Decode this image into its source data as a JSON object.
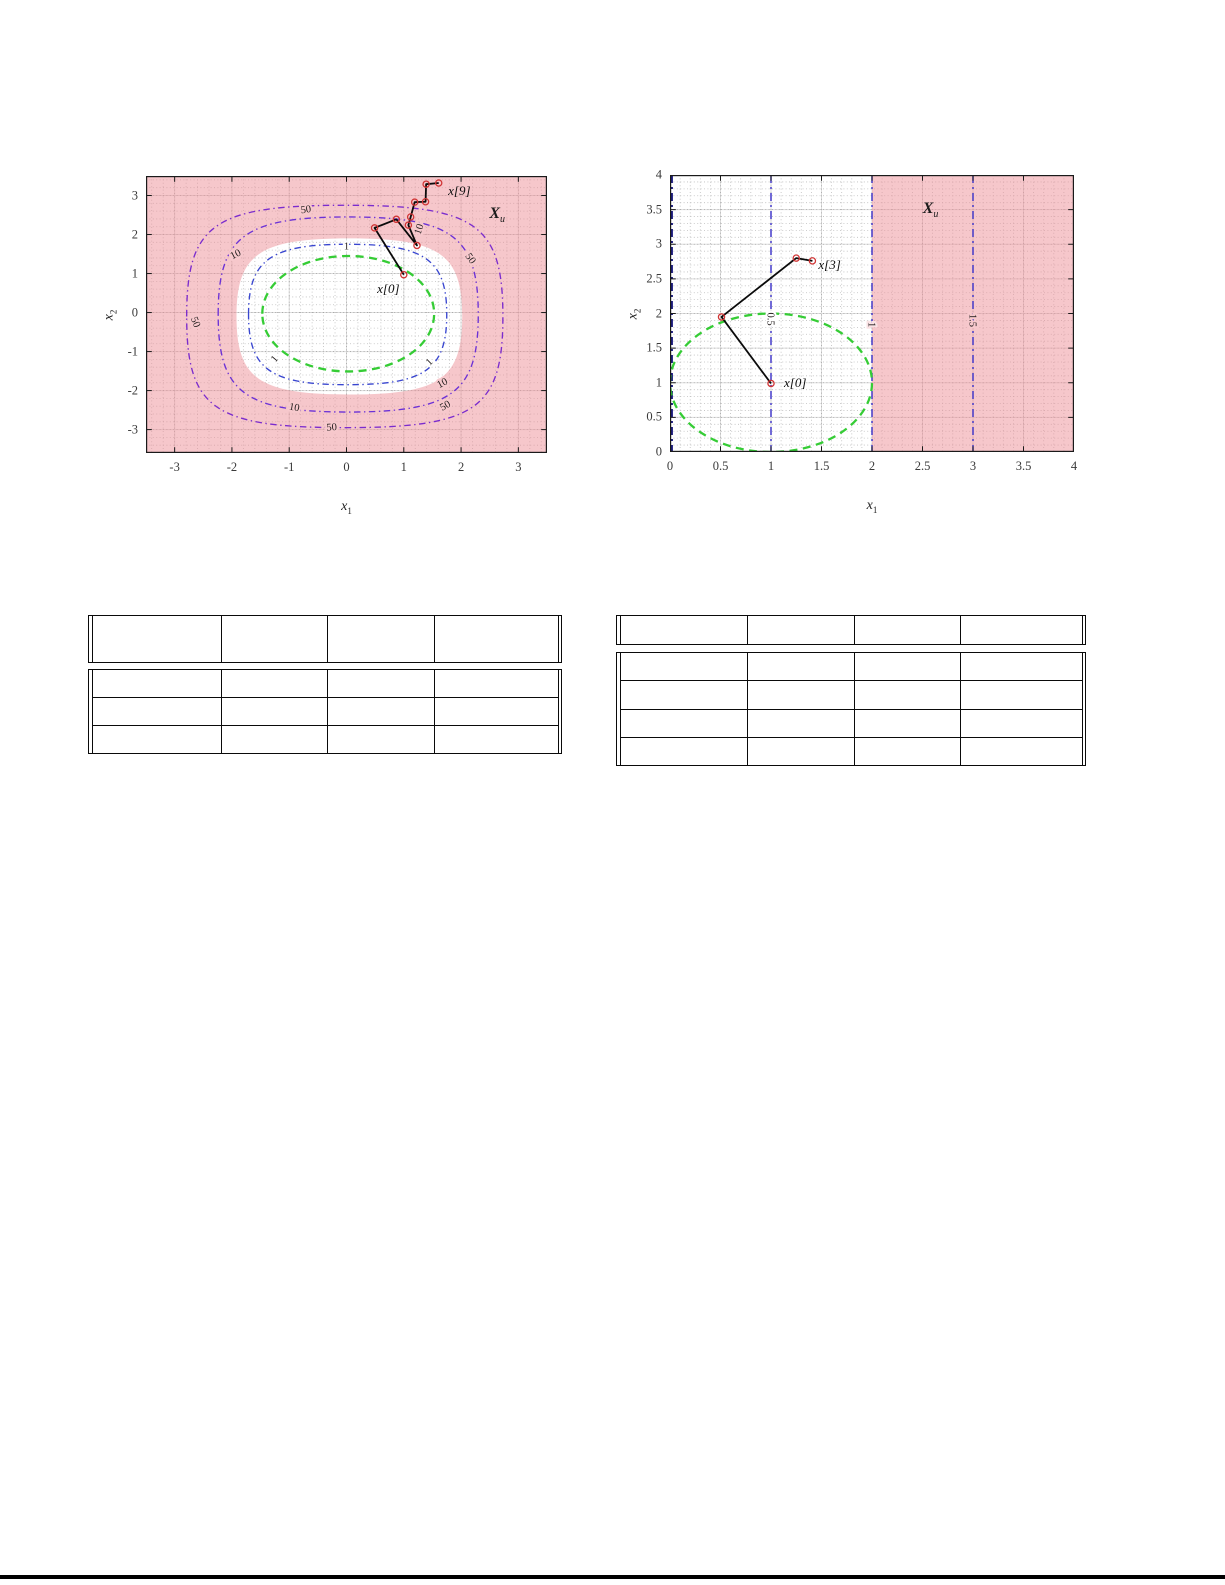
{
  "page": {
    "width": 1225,
    "height": 1585,
    "background": "#ffffff"
  },
  "colors": {
    "unsafe_fill": "#ee8f98",
    "contour_50": "#7b2ccd",
    "contour_10": "#6b31d6",
    "contour_1": "#3946cf",
    "level_set_green": "#35cc35",
    "trajectory_line": "#0b0b0b",
    "trajectory_marker": "#d03434",
    "grid_major": "#000000",
    "grid_minor": "#8a8a8a",
    "frame": "#1a1a1a",
    "contour_label_text": "#211c1c"
  },
  "chart_data": [
    {
      "id": "left-plot",
      "type": "contour",
      "title": "",
      "xlabel": {
        "base": "x",
        "sub": "1"
      },
      "ylabel": {
        "base": "x",
        "sub": "2"
      },
      "xlim": [
        -3.5,
        3.5
      ],
      "ylim": [
        -3.6,
        3.5
      ],
      "xticks": [
        -3,
        -2,
        -1,
        0,
        1,
        2,
        3
      ],
      "yticks": [
        -3,
        -2,
        -1,
        0,
        1,
        2,
        3
      ],
      "minor_step": 0.2,
      "grid": true,
      "frame": {
        "left": 146,
        "top": 176,
        "width": 401,
        "height": 277
      },
      "unsafe_region": {
        "type": "outside-blob",
        "label": {
          "text": "X",
          "sub": "u",
          "x": 2.63,
          "y": 2.5
        },
        "safe_blob": {
          "cx": 0.05,
          "cy": -0.1,
          "rx": 1.97,
          "ry": 2.0,
          "k": 0.8
        }
      },
      "contours": [
        {
          "level": "50",
          "shape": {
            "cx": -0.03,
            "cy": -0.1,
            "rx": 2.76,
            "ry": 2.85,
            "k": 0.83
          },
          "labels": [
            {
              "x": -0.71,
              "y": 2.65,
              "rot": -8,
              "bg": "pink"
            },
            {
              "x": -2.63,
              "y": -0.24,
              "rot": 68,
              "bg": "pink"
            },
            {
              "x": 2.17,
              "y": 1.39,
              "rot": 55,
              "bg": "pink"
            },
            {
              "x": -0.26,
              "y": -2.93,
              "rot": -4,
              "bg": "pink"
            },
            {
              "x": 1.72,
              "y": -2.38,
              "rot": -30,
              "bg": "pink"
            }
          ]
        },
        {
          "level": "10",
          "shape": {
            "cx": 0.03,
            "cy": -0.05,
            "rx": 2.27,
            "ry": 2.5,
            "k": 0.8
          },
          "labels": [
            {
              "x": -1.94,
              "y": 1.5,
              "rot": -27,
              "bg": "pink"
            },
            {
              "x": -0.91,
              "y": -2.42,
              "rot": 10,
              "bg": "pink"
            },
            {
              "x": 1.67,
              "y": -1.8,
              "rot": -28,
              "bg": "pink"
            },
            {
              "x": 1.26,
              "y": 2.14,
              "rot": -72,
              "bg": "pink"
            }
          ]
        },
        {
          "level": "1",
          "shape": {
            "cx": 0.02,
            "cy": -0.05,
            "rx": 1.73,
            "ry": 1.8,
            "k": 0.78
          },
          "labels": [
            {
              "x": 0.0,
              "y": 1.7,
              "rot": 0,
              "bg": "white"
            },
            {
              "x": -1.26,
              "y": -1.18,
              "rot": -50,
              "bg": "white"
            },
            {
              "x": 1.44,
              "y": -1.26,
              "rot": -45,
              "bg": "white"
            }
          ]
        }
      ],
      "initial_level_set": {
        "shape": {
          "cx": 0.03,
          "cy": -0.03,
          "rx": 1.5,
          "ry": 1.48,
          "k": 0.56
        }
      },
      "trajectory": {
        "points": [
          [
            1.0,
            0.97
          ],
          [
            0.49,
            2.17
          ],
          [
            0.87,
            2.39
          ],
          [
            1.23,
            1.72
          ],
          [
            1.08,
            2.24
          ],
          [
            1.12,
            2.45
          ],
          [
            1.19,
            2.83
          ],
          [
            1.38,
            2.84
          ],
          [
            1.39,
            3.29
          ],
          [
            1.61,
            3.32
          ]
        ],
        "labels": [
          {
            "text": "x[0]",
            "x": 0.73,
            "y": 0.6,
            "bg": "white"
          },
          {
            "text": "x[9]",
            "x": 1.97,
            "y": 3.11,
            "bg": "pink"
          }
        ]
      }
    },
    {
      "id": "right-plot",
      "type": "contour",
      "title": "",
      "xlabel": {
        "base": "x",
        "sub": "1"
      },
      "ylabel": {
        "base": "x",
        "sub": "2"
      },
      "xlim": [
        0,
        4
      ],
      "ylim": [
        0,
        4
      ],
      "xticks": [
        0,
        0.5,
        1,
        1.5,
        2,
        2.5,
        3,
        3.5,
        4
      ],
      "yticks": [
        0,
        0.5,
        1,
        1.5,
        2,
        2.5,
        3,
        3.5,
        4
      ],
      "minor_step": 0.1,
      "grid": true,
      "frame": {
        "left": 670,
        "top": 175,
        "width": 404,
        "height": 277
      },
      "unsafe_region": {
        "type": "x-gte",
        "x": 2,
        "label": {
          "text": "X",
          "sub": "u",
          "x": 2.58,
          "y": 3.5
        }
      },
      "vlines": [
        {
          "x": 0.018,
          "color": "#1b1b80",
          "width": 2.2,
          "label": null
        },
        {
          "x": 1,
          "color": "#4238c8",
          "width": 1.5,
          "label": "0.5",
          "label_y": 1.92,
          "bg": "white"
        },
        {
          "x": 2,
          "color": "#4238c8",
          "width": 1.5,
          "label": "1",
          "label_y": 1.84,
          "bg": "edge"
        },
        {
          "x": 3,
          "color": "#4238c8",
          "width": 1.5,
          "label": "1.5",
          "label_y": 1.9,
          "bg": "pink"
        }
      ],
      "initial_level_set": {
        "shape": {
          "cx": 1.0,
          "cy": 1.0,
          "rx": 1.0,
          "ry": 1.0,
          "k": 0.5523
        }
      },
      "trajectory": {
        "points": [
          [
            1.0,
            0.99
          ],
          [
            0.51,
            1.95
          ],
          [
            1.25,
            2.8
          ],
          [
            1.41,
            2.76
          ]
        ],
        "labels": [
          {
            "text": "x[0]",
            "x": 1.24,
            "y": 0.99,
            "bg": "white"
          },
          {
            "text": "x[3]",
            "x": 1.58,
            "y": 2.7,
            "bg": "white"
          }
        ]
      }
    }
  ],
  "tables": [
    {
      "id": "left-table",
      "x": 88,
      "y": 615,
      "width": 474,
      "header_height": 48,
      "gap": 6,
      "body_height": 85,
      "body_rows": 3,
      "col_widths_pct": [
        27.6,
        22.8,
        23.0,
        26.6
      ],
      "header_cells": [
        "",
        "",
        "",
        ""
      ],
      "body_cells": [
        [
          "",
          "",
          "",
          ""
        ],
        [
          "",
          "",
          "",
          ""
        ],
        [
          "",
          "",
          "",
          ""
        ]
      ]
    },
    {
      "id": "right-table",
      "x": 616,
      "y": 615,
      "width": 470,
      "header_height": 30,
      "gap": 7,
      "body_height": 114,
      "body_rows": 4,
      "col_widths_pct": [
        27.4,
        23.3,
        23.0,
        26.3
      ],
      "header_cells": [
        "",
        "",
        "",
        ""
      ],
      "body_cells": [
        [
          "",
          "",
          "",
          ""
        ],
        [
          "",
          "",
          "",
          ""
        ],
        [
          "",
          "",
          "",
          ""
        ],
        [
          "",
          "",
          "",
          ""
        ]
      ]
    }
  ],
  "bottom_rule": {
    "x": 0,
    "y": 1575,
    "width": 1225,
    "height": 3.5,
    "color": "#000000"
  }
}
